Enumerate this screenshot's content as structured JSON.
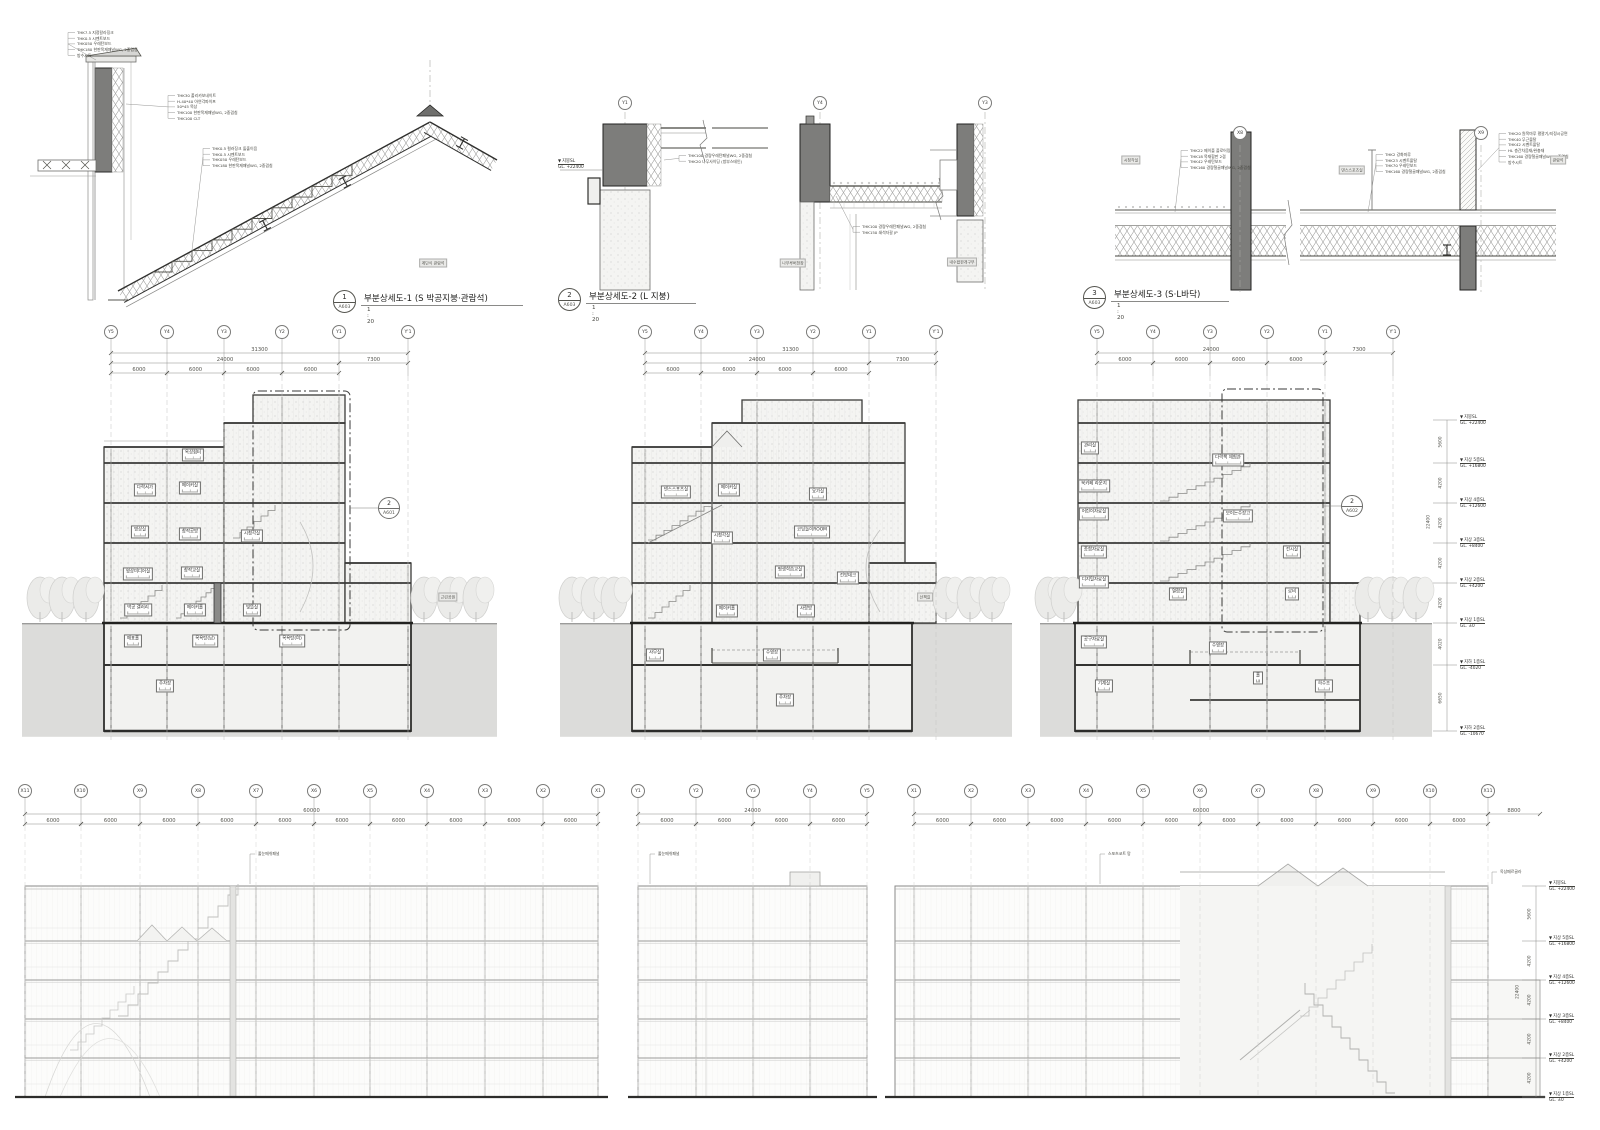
{
  "sheet": {
    "background": "#ffffff",
    "line_color": "#3a3a38",
    "earth_color": "#dcdcda",
    "dark_fill": "#7d7d7b",
    "speck_color": "#cfcfcd"
  },
  "details": [
    {
      "num": "1",
      "ref": "A603",
      "title": "부분상세도-1 (S 박공지붕·관람석)",
      "scale": "1 : 20",
      "notes_left": [
        "THK7.5 지정칼라징크",
        "THK0.5 시멘트보드",
        "THK050 우레탄보드",
        "THK180 한판목재패널WG, 2중겹침",
        "방수시트"
      ],
      "notes_mid": [
        "THK0.5 컬러징크 돌출이음",
        "THK0.5 시멘트보드",
        "THK050 우레탄보드",
        "THK180 한판목재패널WG, 2중겹침"
      ],
      "notes_right": [
        "THK30 폴리카보네이트",
        "H-40*40 아연각파이프",
        "50*45 목상",
        "THK100 한판목재패널WG, 2중겹침",
        "THK100 CLT"
      ],
      "tags": [
        {
          "t": "계단식 관람석",
          "x": 433,
          "y": 263
        }
      ]
    },
    {
      "num": "2",
      "ref": "A603",
      "title": "부분상세도-2 (L 지붕)",
      "scale": "1 : 20",
      "bubbles": [
        {
          "t": "Y1",
          "x": 625,
          "y": 103
        },
        {
          "t": "Y4",
          "x": 820,
          "y": 103
        },
        {
          "t": "Y3",
          "x": 985,
          "y": 103
        }
      ],
      "level": {
        "name": "지붕SL",
        "value": "GL. +22400",
        "x": 594,
        "y": 158
      },
      "notes_a": [
        "THK100 경량우레탄패널WG, 2중겹침",
        "THK20 나무사이딩 (방부스테인)"
      ],
      "notes_b": [
        "THK100 경량우레탄패널WG, 2중겹침",
        "THK150 쇄석자갈 JP"
      ],
      "tags": [
        {
          "t": "나무루버천장",
          "x": 793,
          "y": 263
        },
        {
          "t": "내수합판개구부",
          "x": 962,
          "y": 262
        }
      ]
    },
    {
      "num": "3",
      "ref": "A603",
      "title": "부분상세도-3 (S·L바닥)",
      "scale": "1 : 20",
      "bubbles": [
        {
          "t": "X8",
          "x": 1240,
          "y": 133
        },
        {
          "t": "X9",
          "x": 1481,
          "y": 133
        }
      ],
      "notes_a": [
        "THK22 메이플 플로어링",
        "THK18 목재합판 2겹",
        "THK42 우레탄보드",
        "THK160 경량철골패널WG, 2중겹침"
      ],
      "notes_b": [
        "THK2 강화마루",
        "THK23 시멘트몰탈",
        "THK70 우레탄보드",
        "THK160 경량철골패널WG, 2중겹침"
      ],
      "notes_c": [
        "THK20 원목마루 평깔기/지정시공면",
        "THK40 무근몰탈",
        "THK42 시멘트몰탈",
        "HL 층간차음재/완충재",
        "THK160 경량철골패널WG, 2중겹침",
        "방수시트"
      ],
      "tags": [
        {
          "t": "시청각실",
          "x": 1131,
          "y": 160
        },
        {
          "t": "댄스스포츠실",
          "x": 1352,
          "y": 170
        },
        {
          "t": "관람석",
          "x": 1558,
          "y": 160
        }
      ]
    }
  ],
  "sections": [
    {
      "name": "단면도 1",
      "grid": [
        "Y5",
        "Y4",
        "Y3",
        "Y2",
        "Y1",
        "Y'1"
      ],
      "total": "31300",
      "mid": [
        "24000",
        "7300"
      ],
      "sub": [
        "6000",
        "6000",
        "6000",
        "6000"
      ],
      "callout": {
        "num": "2",
        "ref": "A601"
      },
      "rooms": [
        {
          "t": "옥상쉼터",
          "x": 193,
          "y": 455
        },
        {
          "t": "다락서가",
          "x": 145,
          "y": 490
        },
        {
          "t": "메이커실",
          "x": 190,
          "y": 488
        },
        {
          "t": "명상실",
          "x": 140,
          "y": 532
        },
        {
          "t": "창작공방",
          "x": 190,
          "y": 534
        },
        {
          "t": "시청각실",
          "x": 252,
          "y": 536
        },
        {
          "t": "영상미디어실",
          "x": 138,
          "y": 574
        },
        {
          "t": "창작교실",
          "x": 192,
          "y": 573
        },
        {
          "t": "박공 갤러리",
          "x": 138,
          "y": 610
        },
        {
          "t": "메이커홀",
          "x": 195,
          "y": 610
        },
        {
          "t": "빛뜰실",
          "x": 252,
          "y": 610
        },
        {
          "t": "매표홀",
          "x": 133,
          "y": 641
        },
        {
          "t": "목욕탕(남)",
          "x": 205,
          "y": 641
        },
        {
          "t": "목욕탕(여)",
          "x": 292,
          "y": 641
        },
        {
          "t": "주차장",
          "x": 165,
          "y": 686
        }
      ],
      "tags": [
        {
          "t": "근린공원",
          "x": 448,
          "y": 597
        }
      ]
    },
    {
      "name": "단면도 2",
      "grid": [
        "Y5",
        "Y4",
        "Y3",
        "Y2",
        "Y1",
        "Y'1"
      ],
      "total": "31300",
      "mid": [
        "24000",
        "7300"
      ],
      "sub": [
        "6000",
        "6000",
        "6000",
        "6000"
      ],
      "rooms": [
        {
          "t": "댄스스포츠실",
          "x": 676,
          "y": 492
        },
        {
          "t": "메이커실",
          "x": 729,
          "y": 490
        },
        {
          "t": "요가실",
          "x": 818,
          "y": 494
        },
        {
          "t": "시청각실",
          "x": 722,
          "y": 538
        },
        {
          "t": "코딩놀이ROOM",
          "x": 812,
          "y": 532
        },
        {
          "t": "평생학습교실",
          "x": 790,
          "y": 572
        },
        {
          "t": "전망데크",
          "x": 848,
          "y": 578
        },
        {
          "t": "메이커홀",
          "x": 727,
          "y": 611
        },
        {
          "t": "사랑방",
          "x": 806,
          "y": 611
        },
        {
          "t": "사무실",
          "x": 655,
          "y": 655
        },
        {
          "t": "수영장",
          "x": 772,
          "y": 655
        },
        {
          "t": "주차장",
          "x": 785,
          "y": 700
        }
      ],
      "tags": [
        {
          "t": "산책길",
          "x": 925,
          "y": 597
        }
      ]
    },
    {
      "name": "단면도 3",
      "grid": [
        "Y5",
        "Y4",
        "Y3",
        "Y2",
        "Y1",
        "Y'1"
      ],
      "mid": [
        "24000",
        "7300"
      ],
      "sub": [
        "6000",
        "6000",
        "6000",
        "6000"
      ],
      "callout": {
        "num": "2",
        "ref": "A602"
      },
      "rooms": [
        {
          "t": "관리실",
          "x": 1090,
          "y": 448
        },
        {
          "t": "다락책 체험관",
          "x": 1228,
          "y": 460
        },
        {
          "t": "북카페 라운지",
          "x": 1094,
          "y": 486
        },
        {
          "t": "어린이자료실",
          "x": 1094,
          "y": 514
        },
        {
          "t": "보이는수장고",
          "x": 1238,
          "y": 516
        },
        {
          "t": "종합자료실",
          "x": 1094,
          "y": 552
        },
        {
          "t": "전시실",
          "x": 1292,
          "y": 552
        },
        {
          "t": "디지털자료실",
          "x": 1094,
          "y": 582
        },
        {
          "t": "열람실",
          "x": 1178,
          "y": 594
        },
        {
          "t": "로비",
          "x": 1292,
          "y": 594
        },
        {
          "t": "공구자료실",
          "x": 1094,
          "y": 642
        },
        {
          "t": "수영장",
          "x": 1218,
          "y": 648
        },
        {
          "t": "기계실",
          "x": 1104,
          "y": 686
        },
        {
          "t": "홀",
          "x": 1258,
          "y": 678
        },
        {
          "t": "하수조",
          "x": 1324,
          "y": 686
        }
      ],
      "tags": [],
      "levels": {
        "items": [
          {
            "name": "지붕SL",
            "value": "GL. +22400"
          },
          {
            "name": "지상 5층SL",
            "value": "GL. +16800"
          },
          {
            "name": "지상 4층SL",
            "value": "GL. +12600"
          },
          {
            "name": "지상 3층SL",
            "value": "GL. +8400"
          },
          {
            "name": "지상 2층SL",
            "value": "GL. +4200"
          },
          {
            "name": "지상 1층SL",
            "value": "GL. ±0"
          },
          {
            "name": "지하 1층SL",
            "value": "GL. -4020"
          },
          {
            "name": "지하 2층SL",
            "value": "GL. -10670"
          }
        ],
        "vdims": [
          "5600",
          "4200",
          "4200",
          "4200",
          "4200",
          "4020",
          "6650"
        ],
        "overall": "22400"
      }
    }
  ],
  "elevations": [
    {
      "grid": [
        "X11",
        "X10",
        "X9",
        "X8",
        "X7",
        "X6",
        "X5",
        "X4",
        "X3",
        "X2",
        "X1"
      ],
      "total": "60000",
      "sub": [
        "6000",
        "6000",
        "6000",
        "6000",
        "6000",
        "6000",
        "6000",
        "6000",
        "6000",
        "6000"
      ],
      "notes": [
        {
          "t": "줄눈메쉬패널",
          "x": 258,
          "y": 851
        }
      ]
    },
    {
      "grid": [
        "Y1",
        "Y2",
        "Y3",
        "Y4",
        "Y5"
      ],
      "total": "24000",
      "sub": [
        "6000",
        "6000",
        "6000",
        "6000"
      ],
      "notes": [
        {
          "t": "줄눈메쉬패널",
          "x": 658,
          "y": 851
        }
      ]
    },
    {
      "grid": [
        "X1",
        "X2",
        "X3",
        "X4",
        "X5",
        "X6",
        "X7",
        "X8",
        "X9",
        "X10",
        "X11"
      ],
      "total": "60000",
      "extra": "8800",
      "sub": [
        "6000",
        "6000",
        "6000",
        "6000",
        "6000",
        "6000",
        "6000",
        "6000",
        "6000",
        "6000"
      ],
      "notes": [
        {
          "t": "스포츠코트 망",
          "x": 1108,
          "y": 851
        },
        {
          "t": "옥상페르골라",
          "x": 1500,
          "y": 869
        }
      ],
      "levels": {
        "items": [
          {
            "name": "지붕SL",
            "value": "GL. +22400"
          },
          {
            "name": "지상 5층SL",
            "value": "GL. +16800"
          },
          {
            "name": "지상 4층SL",
            "value": "GL. +12600"
          },
          {
            "name": "지상 3층SL",
            "value": "GL. +8400"
          },
          {
            "name": "지상 2층SL",
            "value": "GL. +4200"
          },
          {
            "name": "지상 1층SL",
            "value": "GL. ±0"
          }
        ],
        "vdims": [
          "5600",
          "4200",
          "4200",
          "4200",
          "4200"
        ],
        "overall": "22400"
      }
    }
  ]
}
